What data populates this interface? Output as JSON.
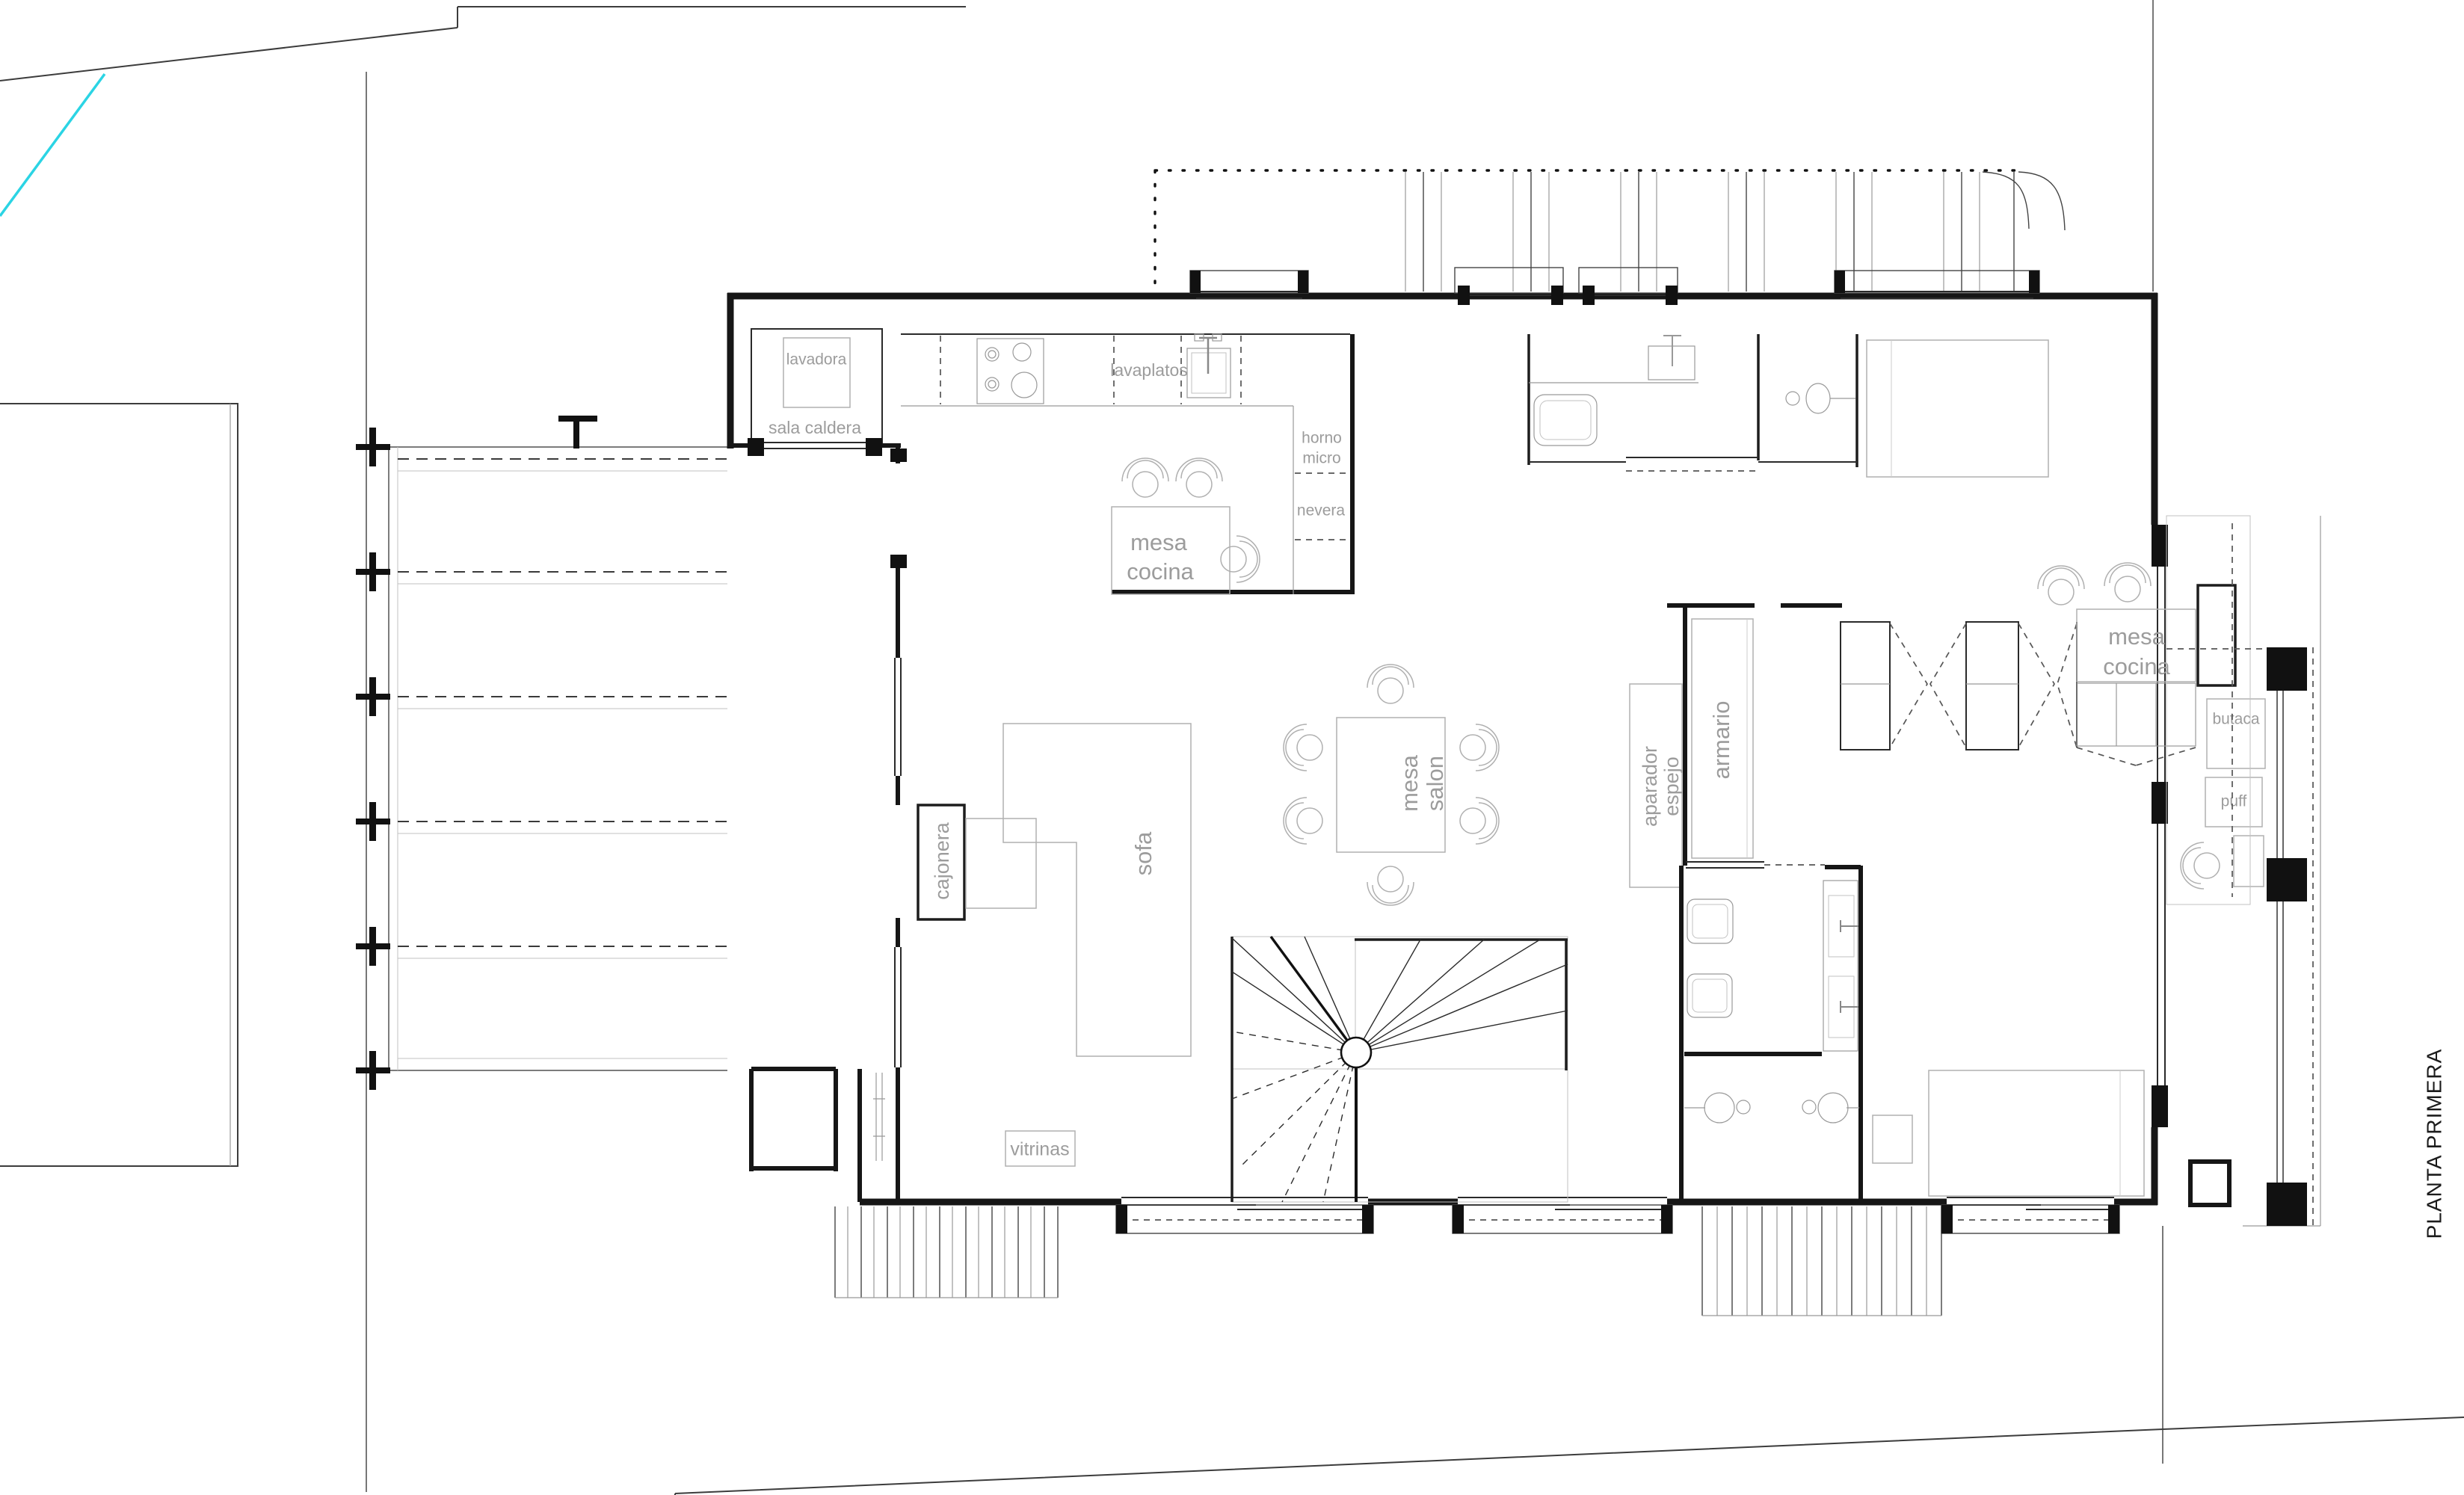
{
  "title": "PLANTA PRIMERA",
  "colors": {
    "accent_cyan": "#2bd4e4",
    "walls": "#161616",
    "furniture_gray": "#b0b0b0",
    "label_gray": "#9c9c9c"
  },
  "rooms": {
    "utility": {
      "washer": "lavadora",
      "name": "sala caldera"
    },
    "kitchen": {
      "dishwasher": "lavaplatos",
      "oven_line1": "horno",
      "oven_line2": "micro",
      "fridge": "nevera",
      "table_line1": "mesa",
      "table_line2": "cocina"
    },
    "living": {
      "table_line1": "mesa",
      "table_line2": "salon",
      "sofa": "sofa",
      "drawers": "cajonera",
      "cabinets": "vitrinas"
    },
    "hall": {
      "wardrobe": "armario",
      "sideboard_line1": "aparador",
      "sideboard_line2": "espejo"
    },
    "suite": {
      "table_line1": "mesa",
      "table_line2": "cocina",
      "armchair": "butaca",
      "pouf": "puff"
    }
  }
}
